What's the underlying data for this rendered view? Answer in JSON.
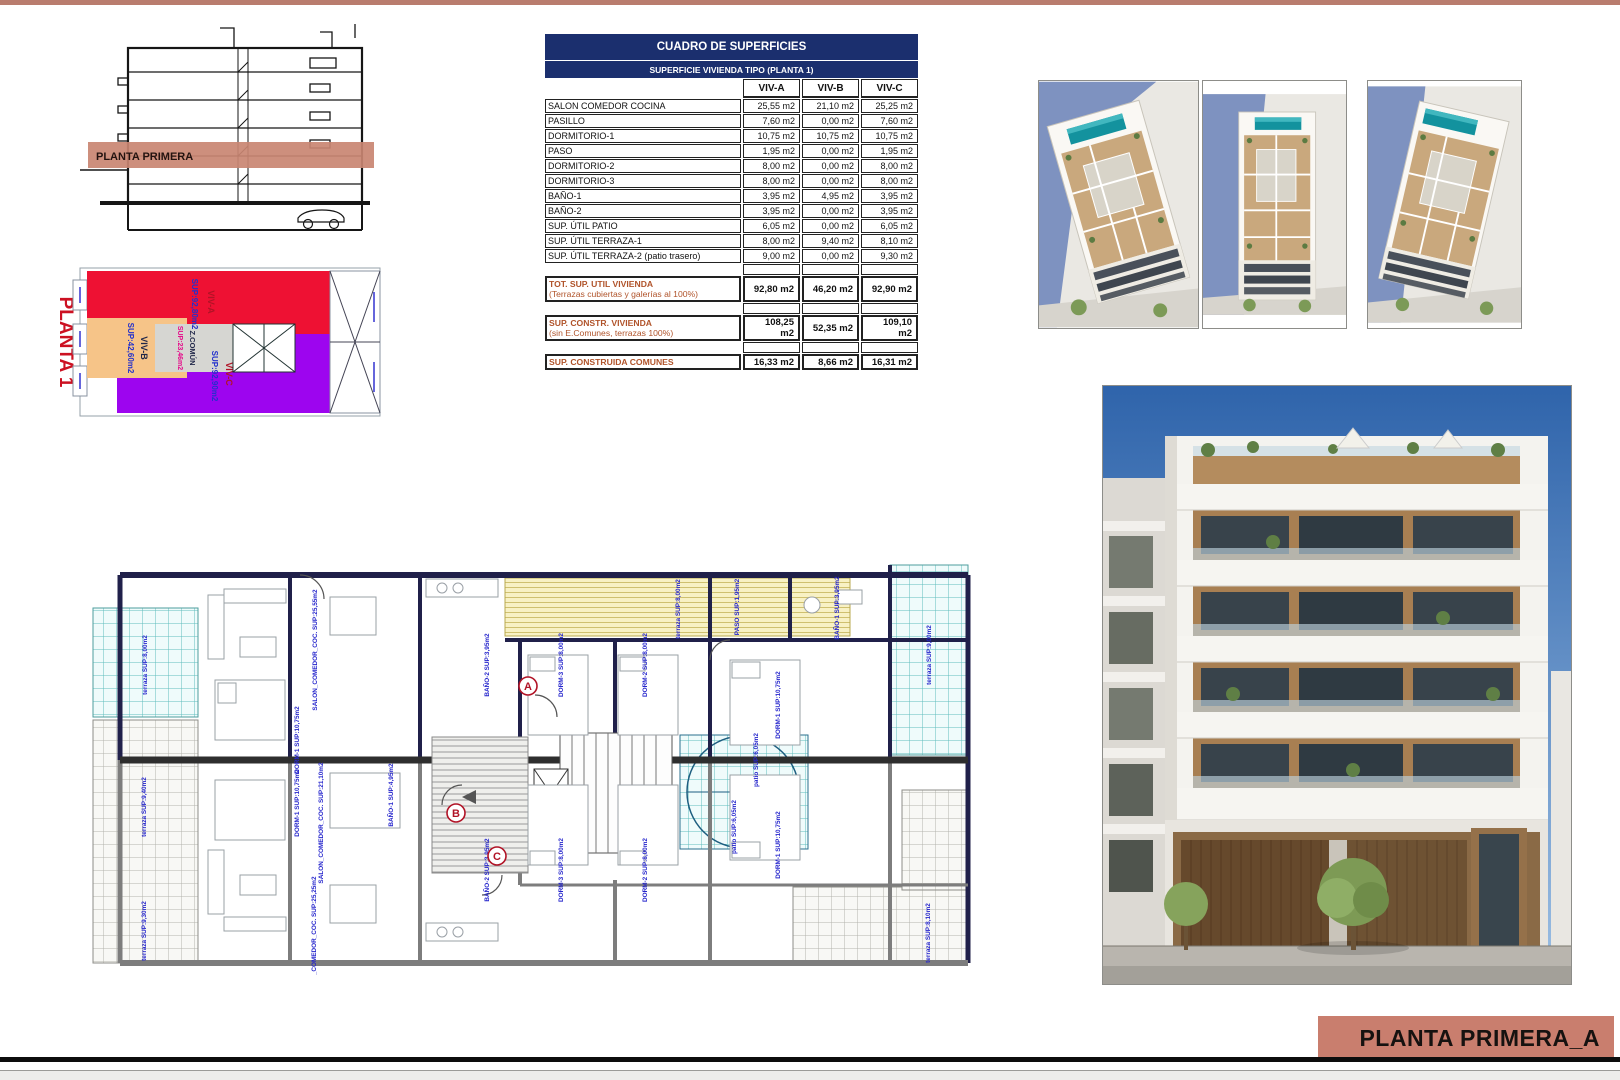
{
  "sheet": {
    "title_block": "PLANTA PRIMERA_A"
  },
  "section": {
    "band_label": "PLANTA PRIMERA"
  },
  "key_plan": {
    "title": "PLANTA 1",
    "zones": [
      {
        "name": "VIV-A",
        "sup": "SUP:92,80m2"
      },
      {
        "name": "VIV-B",
        "sup": "SUP:42,60m2"
      },
      {
        "name": "Z.COMÚN",
        "sup": "SUP:23,46m2"
      },
      {
        "name": "VIV-C",
        "sup": "SUP:92,90m2"
      }
    ]
  },
  "table": {
    "title": "CUADRO DE SUPERFICIES",
    "subtitle": "SUPERFICIE VIVIENDA TIPO  (PLANTA 1)",
    "columns": [
      "VIV-A",
      "VIV-B",
      "VIV-C"
    ],
    "rows": [
      {
        "label": "SALON COMEDOR COCINA",
        "values": [
          "25,55 m2",
          "21,10 m2",
          "25,25 m2"
        ]
      },
      {
        "label": "PASILLO",
        "values": [
          "7,60 m2",
          "0,00 m2",
          "7,60 m2"
        ]
      },
      {
        "label": "DORMITORIO-1",
        "values": [
          "10,75 m2",
          "10,75 m2",
          "10,75 m2"
        ]
      },
      {
        "label": "PASO",
        "values": [
          "1,95 m2",
          "0,00 m2",
          "1,95 m2"
        ]
      },
      {
        "label": "DORMITORIO-2",
        "values": [
          "8,00 m2",
          "0,00 m2",
          "8,00 m2"
        ]
      },
      {
        "label": "DORMITORIO-3",
        "values": [
          "8,00 m2",
          "0,00 m2",
          "8,00 m2"
        ]
      },
      {
        "label": "BAÑO-1",
        "values": [
          "3,95 m2",
          "4,95 m2",
          "3,95 m2"
        ]
      },
      {
        "label": "BAÑO-2",
        "values": [
          "3,95 m2",
          "0,00 m2",
          "3,95 m2"
        ]
      },
      {
        "label": "SUP. ÚTIL PATIO",
        "values": [
          "6,05 m2",
          "0,00 m2",
          "6,05 m2"
        ]
      },
      {
        "label": "SUP. ÚTIL TERRAZA-1",
        "values": [
          "8,00 m2",
          "9,40 m2",
          "8,10 m2"
        ]
      },
      {
        "label": "SUP. ÚTIL TERRAZA-2 (patio trasero)",
        "values": [
          "9,00 m2",
          "0,00 m2",
          "9,30 m2"
        ]
      }
    ],
    "summary_rows": [
      {
        "label": "TOT. SUP. UTIL VIVIENDA",
        "sublabel": "(Terrazas cubiertas y galerías al 100%)",
        "values": [
          "92,80 m2",
          "46,20 m2",
          "92,90 m2"
        ]
      },
      {
        "label": "SUP. CONSTR. VIVIENDA",
        "sublabel": "(sin E.Comunes, terrazas 100%)",
        "values": [
          "108,25 m2",
          "52,35 m2",
          "109,10 m2"
        ]
      },
      {
        "label": "SUP. CONSTRUIDA COMUNES",
        "sublabel": "",
        "values": [
          "16,33 m2",
          "8,66 m2",
          "16,31 m2"
        ]
      }
    ]
  },
  "floor_plan": {
    "letters": [
      "A",
      "B",
      "C"
    ],
    "labels": [
      {
        "text": "terraza SUP:8,00m2"
      },
      {
        "text": "SALON_COMEDOR_COC. SUP:25,55m2"
      },
      {
        "text": "DORM-1 SUP:10,75m2"
      },
      {
        "text": "BAÑO-1 SUP:4,95m2"
      },
      {
        "text": "terraza SUP:8,00m2"
      },
      {
        "text": "BAÑO-2 SUP:3,95m2"
      },
      {
        "text": "DORM-3 SUP:8,00m2"
      },
      {
        "text": "DORM-2 SUP:8,00m2"
      },
      {
        "text": "PASO SUP:1,95m2"
      },
      {
        "text": "BAÑO-1 SUP:3,95m2"
      },
      {
        "text": "DORM-1 SUP:10,75m2"
      },
      {
        "text": "terraza SUP:9,00m2"
      },
      {
        "text": "patio SUP:6,05m2"
      },
      {
        "text": "patio SUP:6,05m2"
      },
      {
        "text": "DORM-1 SUP:10,75m2"
      },
      {
        "text": "SALON_COMEDOR_COC. SUP:21,10m2"
      },
      {
        "text": "SALON_COMEDOR_COC. SUP:25,25m2"
      },
      {
        "text": "terraza SUP:9,40m2"
      },
      {
        "text": "terraza SUP:8,10m2"
      },
      {
        "text": "DORM-2 SUP:8,00m2"
      },
      {
        "text": "DORM-3 SUP:8,00m2"
      },
      {
        "text": "BAÑO-2 SUP:3,95m2"
      },
      {
        "text": "terraza SUP:9,30m2"
      },
      {
        "text": "DORM-1 SUP:10,75m2"
      }
    ]
  },
  "colors": {
    "accent_bar": "#b97c6e",
    "title_box": "#c97e6e",
    "table_header": "#1b2f6e",
    "summary_text": "#b0532a",
    "viv_a": "#ee1133",
    "viv_b": "#f6c488",
    "viv_c": "#9d05ef",
    "zona_comun": "#d6d6d2",
    "plan_label_text": "#2525cc",
    "pool": "#13929e"
  }
}
